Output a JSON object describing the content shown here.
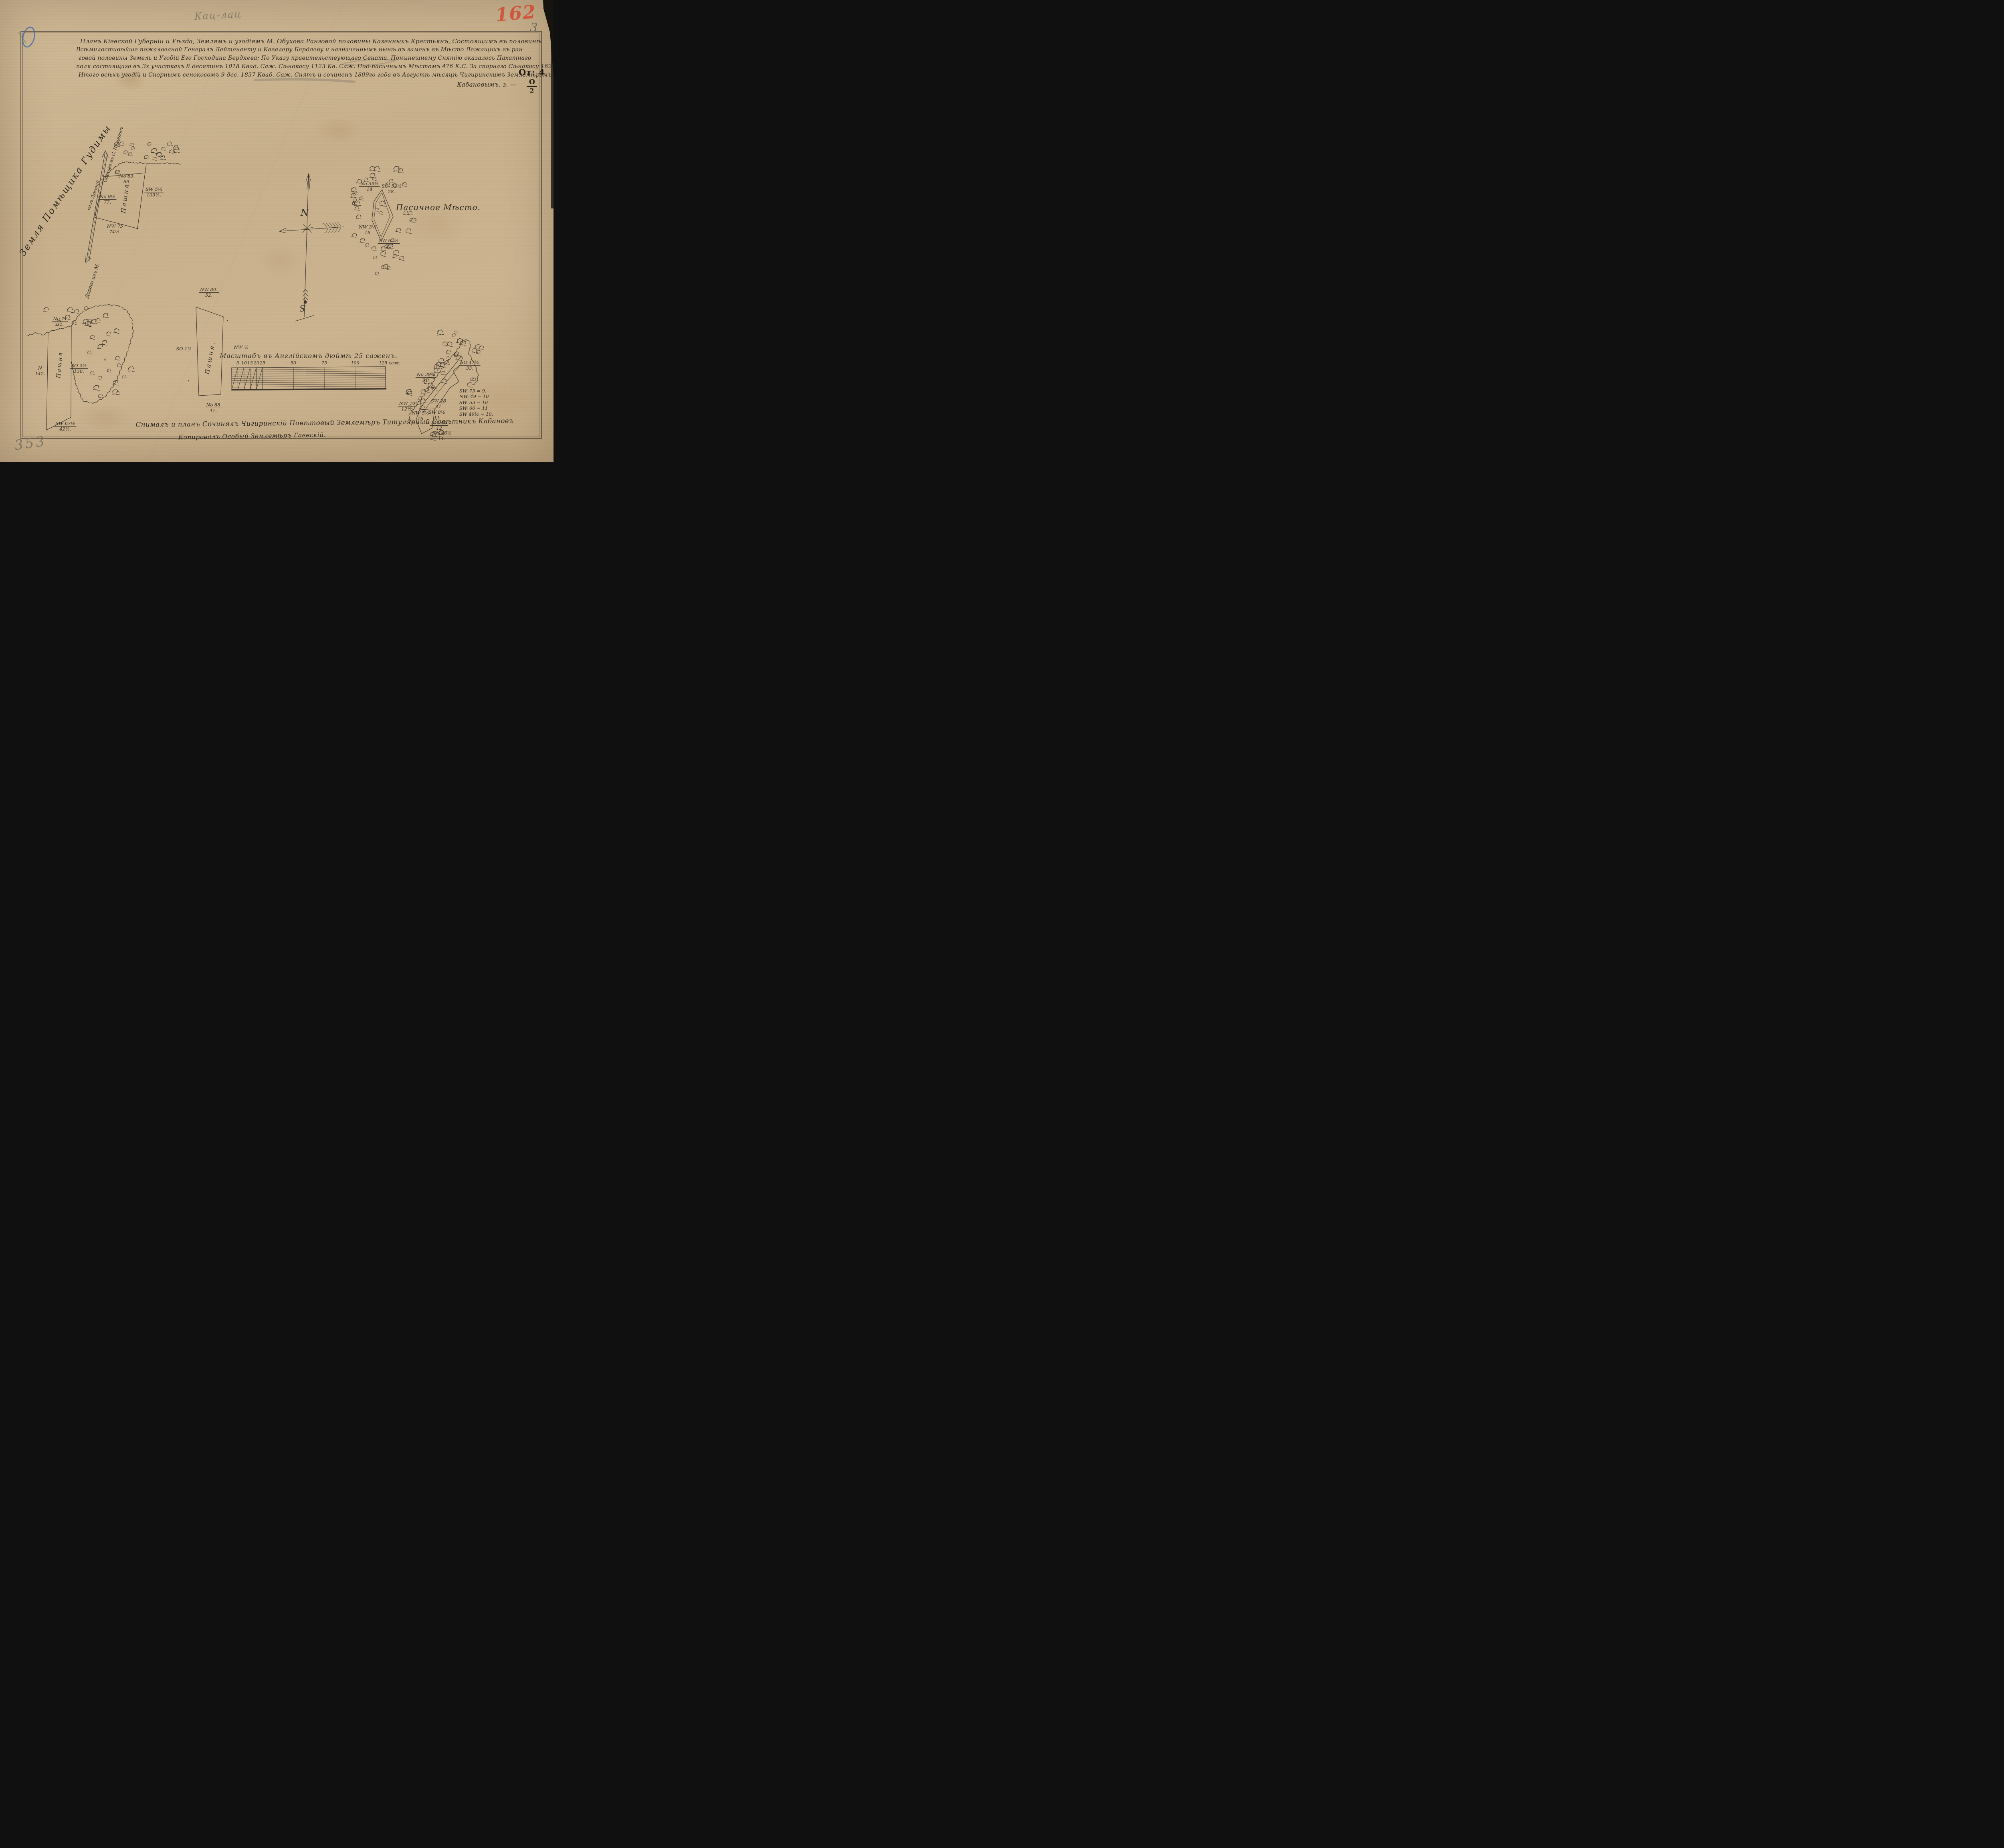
{
  "marks": {
    "red_folio_number": "162",
    "corner_page_number": "3",
    "pencil_inscription": "Кац-лац",
    "bottom_left_pencil_number": "353"
  },
  "folio_mark": {
    "line": "От: 4",
    "numerator": "О",
    "denominator": "2"
  },
  "title": {
    "lines": [
      "Планъ Кіевской Губерніи и Уѣзда, Землямъ и угодіямъ М. Обухова Ранговой половины Казенныхъ Крестьянъ, Состоящимъ въ половинѣ",
      "Всѣмилостивѣйше пожалованой Генералъ Лейтенанту и Кавалеру Бердяеву и назначеннымъ нынѣ въ заменъ въ Мѣсто Лежащихъ въ ран-",
      "говой половины Земель и Угодій Его Господина Бердяева; По Указу правительствующаго Сената. Понынешнему Снятію оказалось Пахатнаго",
      "поля состоящаго въ 3х участкахъ 8 десятинъ 1018 Квад. Саж. Сѣнокосу 1123 Кв. Саж. Под-пасичнымъ Мѣстомъ 476 К.С. За спорнаго Сѣнокосу 1620 К.С.",
      "Итого всѣхъ угодій и Спорнымъ сенокосомъ 9 дес. 1837 Квад. Саж. Снятъ и сочиненъ 1809го года въ Августѣ мѣсяцѣ Чигиринскимъ Землемѣромъ"
    ],
    "signature": "Кабановымъ. з. —"
  },
  "compass": {
    "north": "N",
    "south": "S"
  },
  "parcels": {
    "top_left": {
      "land_note": "Земля Помѣщика Гудимы",
      "road_label_lower": "Дорога изъ М.",
      "road_label_upper": "Обухова въ С. Нещеровъ",
      "road_label_side": "валъ Древній",
      "inner_label": "Пашня",
      "bearings": [
        {
          "dir": "No 83.",
          "len": "69."
        },
        {
          "dir": "SW 5¼",
          "len": "103½."
        },
        {
          "dir": "No 9½",
          "len": "77."
        },
        {
          "dir": "NW 75",
          "len": "74½."
        }
      ]
    },
    "apiary": {
      "name": "Пасичное Мѣсто.",
      "bearings": [
        {
          "dir": "No 39½",
          "len": "14"
        },
        {
          "dir": "SO. 52½",
          "len": "28."
        },
        {
          "dir": "NW 3¼",
          "len": "18"
        },
        {
          "dir": "SW 67½",
          "len": "23"
        }
      ]
    },
    "bottom_left": {
      "inner_label": "Пашня",
      "bearings": [
        {
          "dir": "No 71",
          "len": "37."
        },
        {
          "dir": "SO 2½",
          "len": "138."
        },
        {
          "dir": "N",
          "len": "142."
        },
        {
          "dir": "SW 67½",
          "len": "42½."
        }
      ]
    },
    "middle": {
      "inner_label": "Пашня.",
      "bearings": [
        {
          "dir": "NW 80.",
          "len": "52."
        },
        {
          "dir": "SO 1½",
          "len": ""
        },
        {
          "dir": "NW ½",
          "len": ""
        },
        {
          "dir": "No 88",
          "len": "47."
        }
      ]
    },
    "bottom_right": {
      "bearings": [
        {
          "dir": "No 39¾",
          "len": "91."
        },
        {
          "dir": "SO 47¾",
          "len": "33."
        },
        {
          "dir": "SW 28",
          "len": "21"
        },
        {
          "dir": "SW 8½",
          "len": "11"
        },
        {
          "dir": "SO 3¾",
          "len": "12"
        },
        {
          "dir": "NW 70",
          "len": "12½."
        },
        {
          "dir": "NW 5½",
          "len": "16"
        },
        {
          "dir": "SW 46½",
          "len": "14."
        }
      ],
      "bearing_list": [
        "SW. 73 = 9.",
        "NW. 49 = 10",
        "SW. 53 = 10",
        "SW. 66 = 11",
        "SW 49½ = 10."
      ]
    }
  },
  "scale_bar": {
    "title": "Масштабъ въ Англійскомъ дюймѣ 25 саженъ.",
    "ticks": [
      "5",
      "10",
      "15",
      "20",
      "25",
      "50",
      "75",
      "100",
      "125 саж."
    ]
  },
  "footer": {
    "line1": "Снималъ и планъ Сочинялъ Чигиринскій Повѣтовый Землемѣръ Титулярный Совѣтникъ Кабановъ",
    "line2": "Копировалъ Особый Землемѣръ Гаевскій."
  }
}
